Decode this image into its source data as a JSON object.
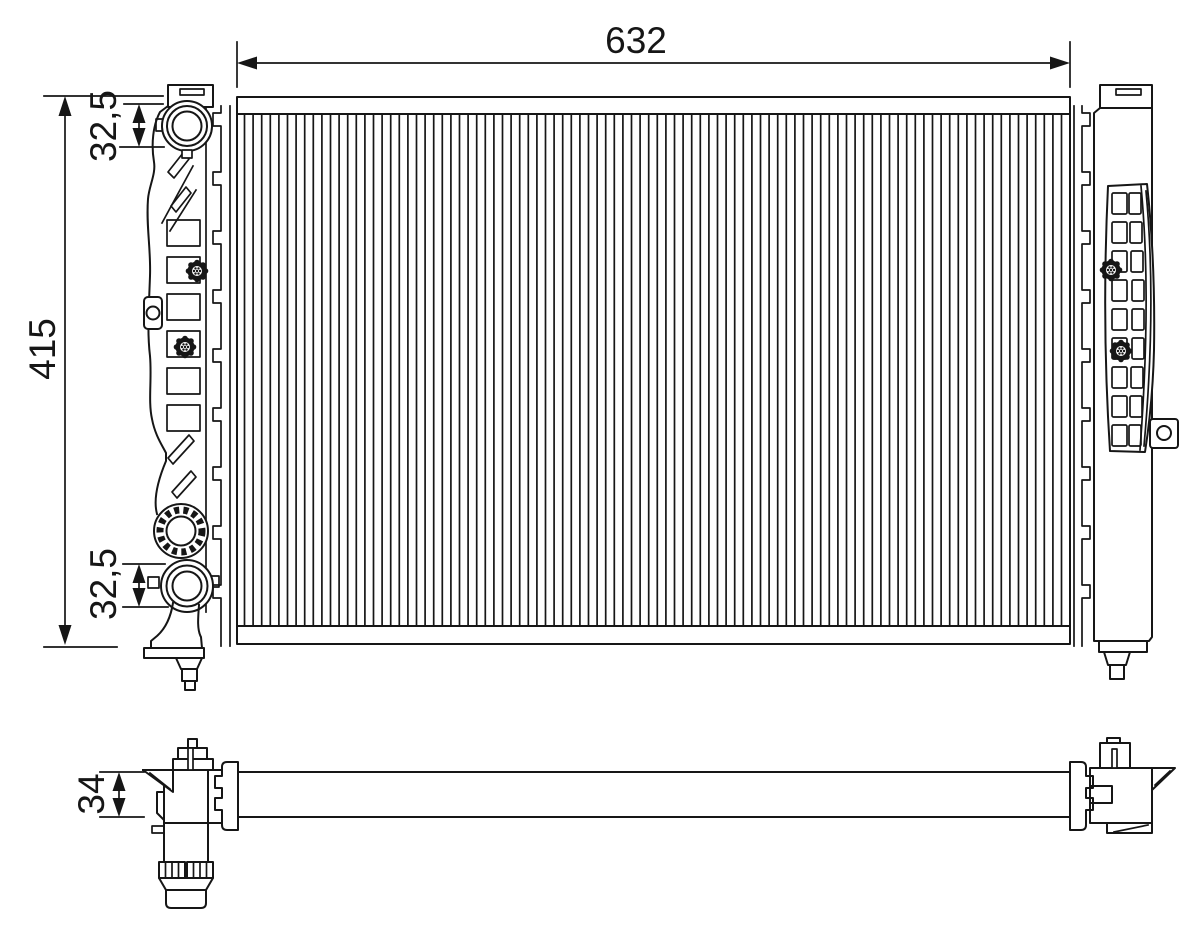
{
  "drawing": {
    "dimensions": {
      "core_width": "632",
      "overall_height": "415",
      "port_top": "32,5",
      "port_bottom": "32,5",
      "core_thickness": "34"
    },
    "colors": {
      "line": "#161616",
      "background": "#ffffff"
    }
  }
}
